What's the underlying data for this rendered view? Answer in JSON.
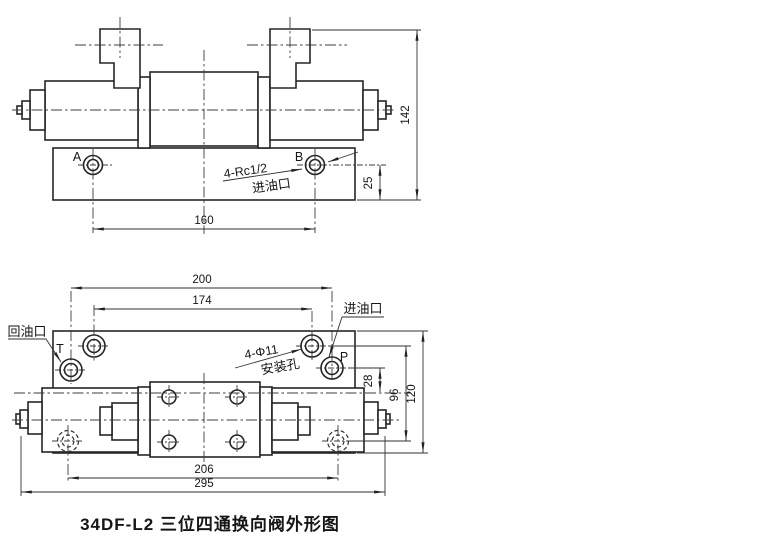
{
  "caption": "34DF-L2 三位四通换向阀外形图",
  "front_view": {
    "port_a": "A",
    "port_b": "B",
    "thread_label": "4-Rc1/2",
    "inlet_label": "进油口",
    "dim_width": "160",
    "dim_height": "142",
    "dim_port_depth": "25"
  },
  "plan_view": {
    "port_t": "T",
    "port_p": "P",
    "return_port_label": "回油口",
    "inlet_port_label": "进油口",
    "mount_hole_label_line1": "4-Φ11",
    "mount_hole_label_line2": "安装孔",
    "dim_port_span": "200",
    "dim_hole_span": "174",
    "dim_port_offset": "28",
    "dim_hole_vspan": "96",
    "dim_plate_height": "120",
    "dim_lower_hole_span": "206",
    "dim_overall_length": "295"
  }
}
